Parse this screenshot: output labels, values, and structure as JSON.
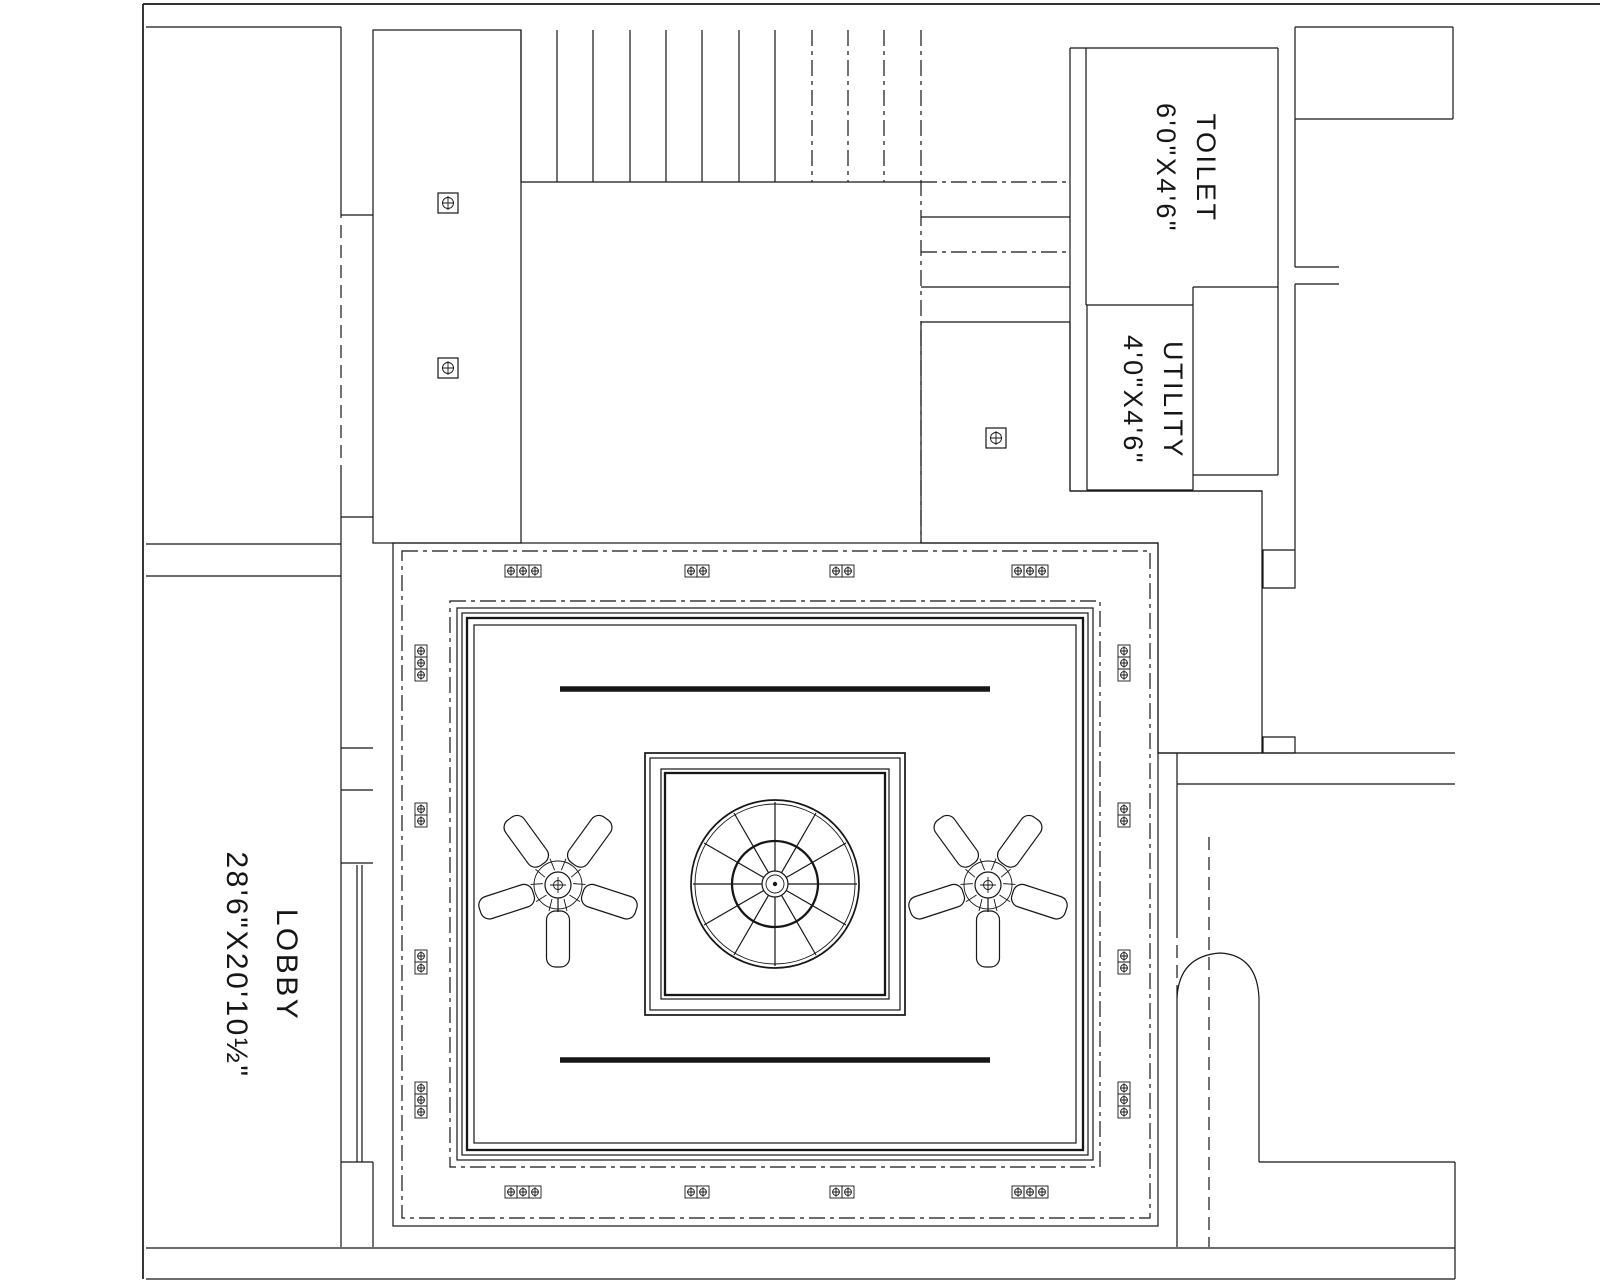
{
  "rooms": {
    "toilet": {
      "name": "TOILET",
      "dims": "6'0\"X4'6\""
    },
    "utility": {
      "name": "UTILITY",
      "dims": "4'0\"X4'6\""
    },
    "lobby": {
      "name": "LOBBY",
      "dims": "28'6\"X20'10½\""
    }
  },
  "symbols": {
    "fan": "ceiling-fan-icon",
    "light": "light-fixture-icon",
    "dome": "ceiling-dome-icon",
    "hatch": "slatted-ceiling-hatch"
  },
  "colors": {
    "ink": "#161616",
    "paper": "#ffffff"
  }
}
